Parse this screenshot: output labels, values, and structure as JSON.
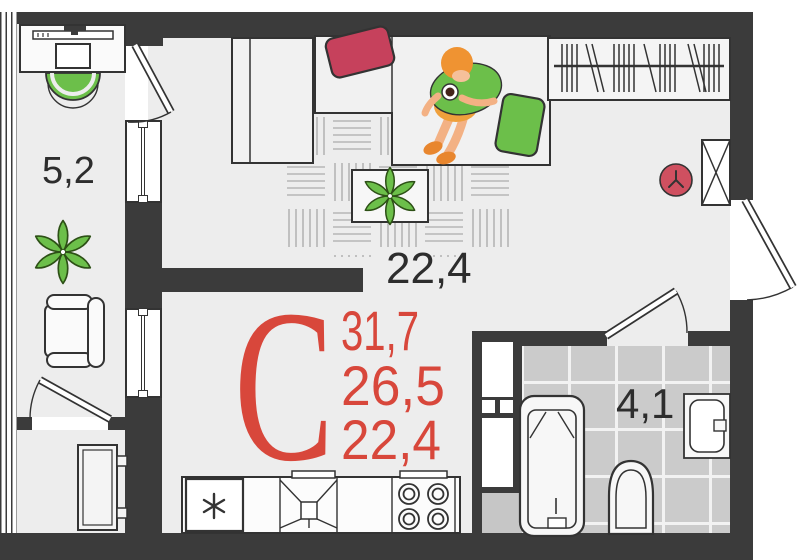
{
  "plan": {
    "type_letter": "С",
    "areas": {
      "total": "31,7",
      "reduced": "26,5",
      "living_area": "22,4"
    },
    "rooms": {
      "balcony": "5,2",
      "living": "22,4",
      "bathroom": "4,1"
    },
    "colors": {
      "accent_red": "#d8473b",
      "wall_dark": "#3b3b3b",
      "furniture_green": "#6cbf4a",
      "pillow_red": "#c6415c",
      "floor": "#ededed",
      "bathroom_tile": "#cbcbcb"
    }
  }
}
